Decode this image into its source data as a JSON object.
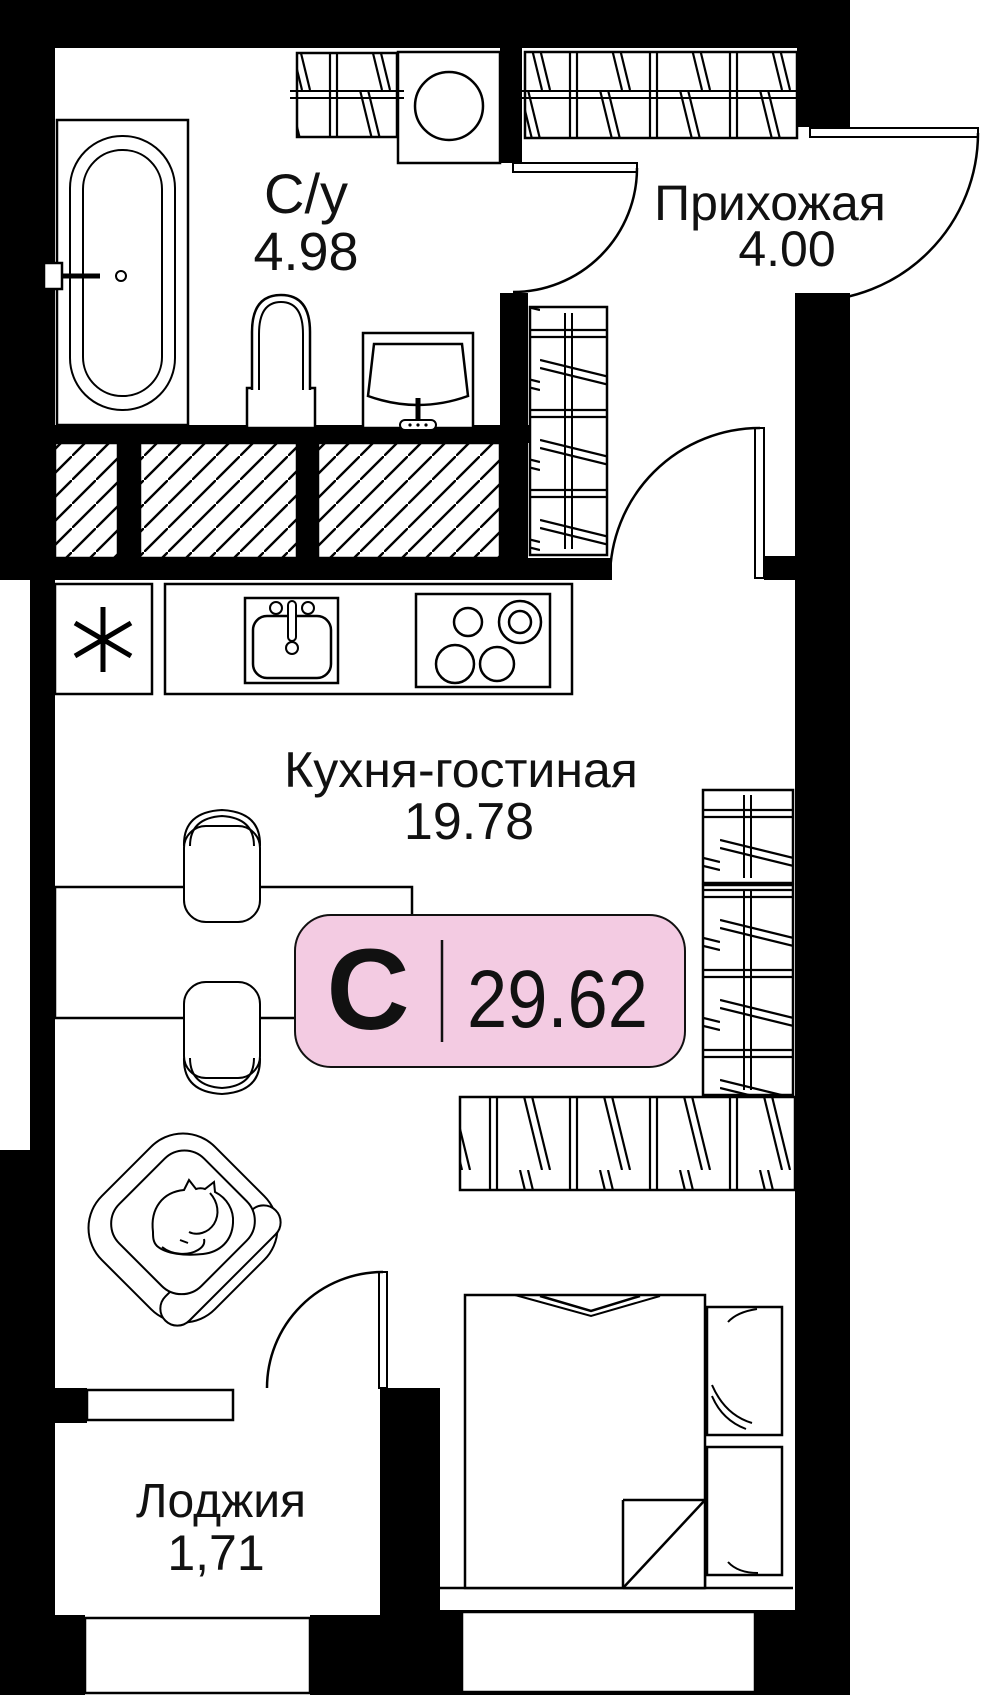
{
  "badge": {
    "letter": "С",
    "area": "29.62",
    "bg": "#F3CBE2",
    "border": "#111111"
  },
  "rooms": [
    {
      "name": "С/у",
      "area": "4.98"
    },
    {
      "name": "Прихожая",
      "area": "4.00"
    },
    {
      "name": "Кухня-гостиная",
      "area": "19.78"
    },
    {
      "name": "Лоджия",
      "area": "1,71"
    }
  ],
  "colors": {
    "ink": "#000000",
    "paper": "#ffffff"
  }
}
